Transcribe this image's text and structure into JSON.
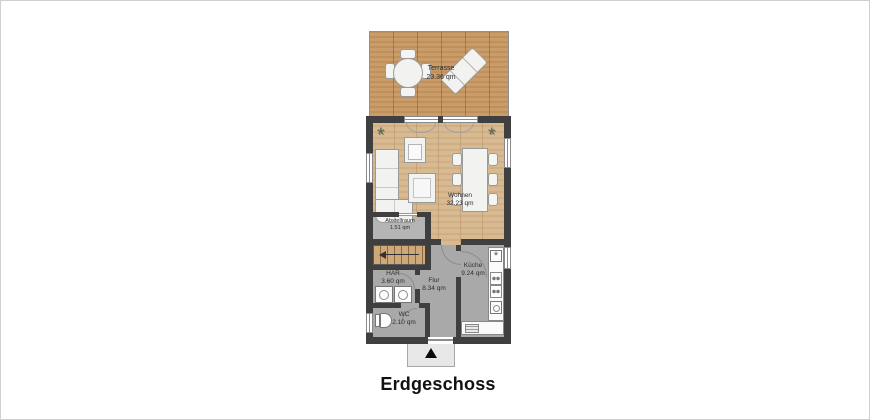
{
  "title": "Erdgeschoss",
  "rooms": {
    "terrasse": {
      "name": "Terrasse",
      "area": "23.36 qm"
    },
    "wohnen": {
      "name": "Wohnen",
      "area": "32.23 qm"
    },
    "abstellraum": {
      "name": "Abstellraum",
      "area": "1.51 qm"
    },
    "har": {
      "name": "HAR",
      "area": "3.60 qm"
    },
    "flur": {
      "name": "Flur",
      "area": "8.34 qm"
    },
    "kueche": {
      "name": "Küche",
      "area": "9.24 qm"
    },
    "wc": {
      "name": "WC",
      "area": "2.10 qm"
    }
  },
  "icons": {
    "plant_glyph": "*",
    "sink_glyph": "*"
  },
  "colors": {
    "wall": "#3f3f3f",
    "terrace_wood": "#c99d6b",
    "interior_wood": "#d6b88f",
    "gray_floor": "#a9a9a9",
    "furniture": "#f2f2f1",
    "background": "#ffffff"
  }
}
